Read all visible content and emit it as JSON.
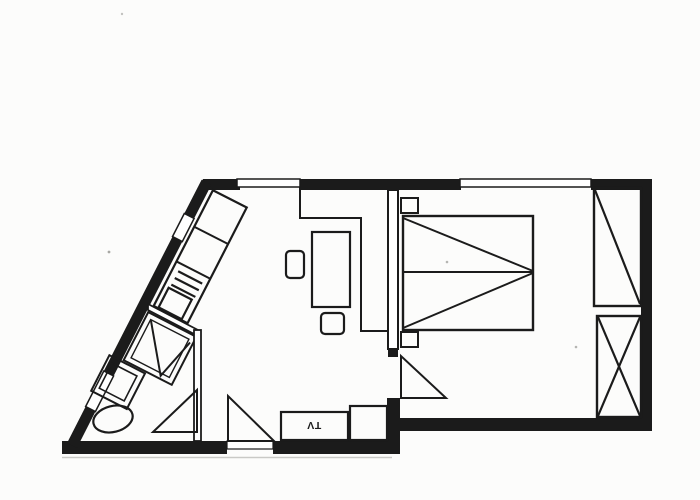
{
  "canvas": {
    "title": "apartment-floor-plan",
    "width": 700,
    "height": 500
  },
  "colors": {
    "ink": "#1b1b1b",
    "paper": "#fcfcfb",
    "white": "#ffffff",
    "shadow": "#c9c9c6",
    "speckle": "#a8a8a4"
  },
  "labels": {
    "tv": "TV"
  },
  "shapes": [
    {
      "t": "polygon",
      "n": "top-wall-corner",
      "a": {
        "points": "203,179 240,179 240,190 198,190",
        "fill": "INK",
        "stroke": "none"
      }
    },
    {
      "t": "rect",
      "n": "top-wall-mid",
      "a": {
        "x": 299,
        "y": 179,
        "width": 162,
        "height": 11,
        "fill": "INK",
        "stroke": "none"
      }
    },
    {
      "t": "rect",
      "n": "top-wall-right",
      "a": {
        "x": 591,
        "y": 179,
        "width": 61,
        "height": 11,
        "fill": "INK",
        "stroke": "none"
      }
    },
    {
      "t": "rect",
      "n": "right-wall",
      "a": {
        "x": 641,
        "y": 179,
        "width": 11,
        "height": 252,
        "fill": "INK",
        "stroke": "none"
      }
    },
    {
      "t": "rect",
      "n": "bedroom-bottom-wall",
      "a": {
        "x": 395,
        "y": 418,
        "width": 257,
        "height": 13,
        "fill": "INK",
        "stroke": "none"
      }
    },
    {
      "t": "rect",
      "n": "hall-bottom-wall-left",
      "a": {
        "x": 62,
        "y": 441,
        "width": 165,
        "height": 13,
        "fill": "INK",
        "stroke": "none"
      }
    },
    {
      "t": "rect",
      "n": "hall-bottom-wall-right",
      "a": {
        "x": 273,
        "y": 441,
        "width": 115,
        "height": 13,
        "fill": "INK",
        "stroke": "none"
      }
    },
    {
      "t": "rect",
      "n": "divider-wall-bottom-bar",
      "a": {
        "x": 387,
        "y": 398,
        "width": 13,
        "height": 56,
        "fill": "INK",
        "stroke": "none"
      }
    },
    {
      "t": "line",
      "n": "diagonal-wall-upper",
      "a": {
        "x1": 206.5,
        "y1": 182.2,
        "x2": 189.2,
        "y2": 216.0,
        "stroke-width": 11
      }
    },
    {
      "t": "line",
      "n": "diagonal-wall-mid",
      "a": {
        "x1": 177.4,
        "y1": 239.1,
        "x2": 108.7,
        "y2": 373.5,
        "stroke-width": 11
      }
    },
    {
      "t": "line",
      "n": "diagonal-wall-lower",
      "a": {
        "x1": 90.5,
        "y1": 409.1,
        "x2": 71.9,
        "y2": 445.6,
        "stroke-width": 11
      }
    },
    {
      "t": "polygon",
      "n": "diagonal-window-small",
      "a": {
        "points": "184.3,213.5 172.5,236.6 182.3,241.6 194.1,218.5",
        "fill": "#ffffff",
        "stroke-width": 1.5
      }
    },
    {
      "t": "polygon",
      "n": "diagonal-window-large",
      "a": {
        "points": "103.8,371 85.6,406.6 95.4,411.6 113.6,376",
        "fill": "#ffffff",
        "stroke-width": 1.5
      }
    },
    {
      "t": "rect",
      "n": "top-window-left",
      "a": {
        "x": 237,
        "y": 179,
        "width": 63,
        "height": 8,
        "fill": "#ffffff",
        "stroke-width": 1.5
      }
    },
    {
      "t": "rect",
      "n": "top-window-right",
      "a": {
        "x": 460,
        "y": 179,
        "width": 131,
        "height": 8,
        "fill": "#ffffff",
        "stroke-width": 1.5
      }
    },
    {
      "t": "rect",
      "n": "entry-door-threshold",
      "a": {
        "x": 227,
        "y": 441,
        "width": 46,
        "height": 8,
        "fill": "#ffffff",
        "stroke-width": 1.2
      }
    },
    {
      "t": "line",
      "n": "scan-shadow-line",
      "a": {
        "x1": 62,
        "y1": 457.5,
        "x2": 392,
        "y2": 457.5,
        "stroke": "#c9c9c6",
        "stroke-width": 1.6
      }
    },
    {
      "t": "g",
      "n": "kitchen-group",
      "a": {
        "transform": "rotate(27.1 212 192)"
      },
      "children": [
        {
          "t": "rect",
          "n": "kitchen-counter",
          "a": {
            "x": 212,
            "y": 190,
            "width": 38,
            "height": 130,
            "stroke-width": 2.2
          }
        },
        {
          "t": "line",
          "n": "counter-divider-1",
          "a": {
            "x1": 212,
            "y1": 231,
            "x2": 250,
            "y2": 231,
            "stroke-width": 2
          }
        },
        {
          "t": "line",
          "n": "counter-divider-2",
          "a": {
            "x1": 212,
            "y1": 270,
            "x2": 250,
            "y2": 270,
            "stroke-width": 2
          }
        },
        {
          "t": "line",
          "n": "drainer-line-1",
          "a": {
            "x1": 218,
            "y1": 278,
            "x2": 245,
            "y2": 278,
            "stroke-width": 2.2
          }
        },
        {
          "t": "line",
          "n": "drainer-line-2",
          "a": {
            "x1": 218,
            "y1": 285.5,
            "x2": 245,
            "y2": 285.5,
            "stroke-width": 2.2
          }
        },
        {
          "t": "line",
          "n": "drainer-line-3",
          "a": {
            "x1": 218,
            "y1": 293,
            "x2": 245,
            "y2": 293,
            "stroke-width": 2.2
          }
        },
        {
          "t": "rect",
          "n": "kitchen-sink",
          "a": {
            "x": 217,
            "y": 297,
            "width": 26,
            "height": 22,
            "stroke-width": 2.2
          }
        },
        {
          "t": "rect",
          "n": "shower-outer",
          "a": {
            "x": 210,
            "y": 328,
            "width": 54,
            "height": 54,
            "stroke-width": 2
          }
        },
        {
          "t": "rect",
          "n": "shower-inner",
          "a": {
            "x": 215.5,
            "y": 333.5,
            "width": 43,
            "height": 43,
            "stroke-width": 1.4
          }
        },
        {
          "t": "polyline",
          "n": "shower-door-fold",
          "a": {
            "points": "216,334 250,379 261,336",
            "stroke-width": 2
          }
        },
        {
          "t": "rect",
          "n": "washbasin-outer",
          "a": {
            "x": 195,
            "y": 384,
            "width": 40,
            "height": 40,
            "stroke-width": 2
          }
        },
        {
          "t": "rect",
          "n": "washbasin-inner",
          "a": {
            "x": 201,
            "y": 390,
            "width": 28,
            "height": 28,
            "stroke-width": 1.6
          }
        }
      ]
    },
    {
      "t": "polygon",
      "n": "bathroom-wall-diagonal",
      "a": {
        "points": "148,304 198,330 198,336 148,310",
        "fill": "#ffffff",
        "stroke-width": 1.8
      }
    },
    {
      "t": "rect",
      "n": "bathroom-wall-vertical",
      "a": {
        "x": 194,
        "y": 330,
        "width": 7,
        "height": 111,
        "fill": "#ffffff",
        "stroke-width": 1.8
      }
    },
    {
      "t": "ellipse",
      "n": "toilet",
      "a": {
        "cx": 113,
        "cy": 419,
        "rx": 20,
        "ry": 13,
        "transform": "rotate(-14 113 419)",
        "stroke-width": 2.2
      }
    },
    {
      "t": "polygon",
      "n": "bathroom-door-leaf",
      "a": {
        "points": "197,390 197,432 153,432",
        "stroke-width": 2
      }
    },
    {
      "t": "polygon",
      "n": "entry-door-leaf",
      "a": {
        "points": "228,396 228,441 274,441",
        "stroke-width": 2
      }
    },
    {
      "t": "polyline",
      "n": "entry-wardrobe-outline",
      "a": {
        "points": "300,190 300,218 361,218 361,331 388,331",
        "stroke-width": 2
      }
    },
    {
      "t": "rect",
      "n": "table",
      "a": {
        "x": 312,
        "y": 232,
        "width": 38,
        "height": 75,
        "stroke-width": 2.2
      }
    },
    {
      "t": "rect",
      "n": "chair-left",
      "a": {
        "x": 286,
        "y": 251,
        "width": 18,
        "height": 27,
        "rx": 4,
        "stroke-width": 2.2
      }
    },
    {
      "t": "rect",
      "n": "chair-bottom",
      "a": {
        "x": 321,
        "y": 313,
        "width": 23,
        "height": 21,
        "rx": 4,
        "stroke-width": 2.2
      }
    },
    {
      "t": "rect",
      "n": "tv-stand",
      "a": {
        "x": 281,
        "y": 412,
        "width": 67,
        "height": 28,
        "stroke-width": 2.2
      }
    },
    {
      "t": "text",
      "n": "tv-label",
      "bind": "labels.tv",
      "a": {
        "x": 314,
        "y": 430,
        "text-anchor": "middle",
        "font-size": "10.5",
        "font-weight": "700",
        "transform": "rotate(180 314 426)",
        "fill": "INK",
        "stroke": "none"
      }
    },
    {
      "t": "rect",
      "n": "tv-side-cabinet",
      "a": {
        "x": 350,
        "y": 406,
        "width": 37,
        "height": 34,
        "stroke-width": 2.2
      }
    },
    {
      "t": "rect",
      "n": "living-bedroom-wall",
      "a": {
        "x": 388,
        "y": 190,
        "width": 10,
        "height": 159,
        "fill": "#ffffff",
        "stroke-width": 2
      }
    },
    {
      "t": "rect",
      "n": "bedroom-door-jamb",
      "a": {
        "x": 388,
        "y": 349,
        "width": 10,
        "height": 8,
        "fill": "INK",
        "stroke": "none"
      }
    },
    {
      "t": "polygon",
      "n": "bedroom-door-leaf",
      "a": {
        "points": "401,356 401,398 446,398",
        "stroke-width": 2
      }
    },
    {
      "t": "rect",
      "n": "double-bed",
      "a": {
        "x": 403,
        "y": 216,
        "width": 130,
        "height": 114,
        "stroke-width": 2.4
      }
    },
    {
      "t": "line",
      "n": "bed-centerline",
      "a": {
        "x1": 403,
        "y1": 272,
        "x2": 533,
        "y2": 272,
        "stroke-width": 2
      }
    },
    {
      "t": "line",
      "n": "bed-diagonal-top",
      "a": {
        "x1": 403,
        "y1": 218,
        "x2": 533,
        "y2": 271,
        "stroke-width": 2
      }
    },
    {
      "t": "line",
      "n": "bed-diagonal-bottom",
      "a": {
        "x1": 403,
        "y1": 328,
        "x2": 533,
        "y2": 273,
        "stroke-width": 2
      }
    },
    {
      "t": "rect",
      "n": "nightstand-top",
      "a": {
        "x": 401,
        "y": 198,
        "width": 17,
        "height": 15,
        "stroke-width": 2
      }
    },
    {
      "t": "rect",
      "n": "nightstand-bottom",
      "a": {
        "x": 401,
        "y": 332,
        "width": 17,
        "height": 15,
        "stroke-width": 2
      }
    },
    {
      "t": "rect",
      "n": "wardrobe-upper",
      "a": {
        "x": 594,
        "y": 188,
        "width": 47,
        "height": 118,
        "stroke-width": 2.4
      }
    },
    {
      "t": "line",
      "n": "wardrobe-upper-diagonal",
      "a": {
        "x1": 595,
        "y1": 190,
        "x2": 640,
        "y2": 304,
        "stroke-width": 2.2
      }
    },
    {
      "t": "rect",
      "n": "wardrobe-lower",
      "a": {
        "x": 597,
        "y": 316,
        "width": 44,
        "height": 101,
        "stroke-width": 2.4
      }
    },
    {
      "t": "line",
      "n": "wardrobe-lower-diagonal-1",
      "a": {
        "x1": 598,
        "y1": 317,
        "x2": 640,
        "y2": 416,
        "stroke-width": 2.2
      }
    },
    {
      "t": "line",
      "n": "wardrobe-lower-diagonal-2",
      "a": {
        "x1": 640,
        "y1": 317,
        "x2": 598,
        "y2": 416,
        "stroke-width": 2.2
      }
    },
    {
      "t": "circle",
      "n": "scan-speckle",
      "a": {
        "cx": 109,
        "cy": 252,
        "r": 1.4,
        "fill": "#a8a8a4",
        "stroke": "none"
      }
    },
    {
      "t": "circle",
      "n": "scan-speckle",
      "a": {
        "cx": 447,
        "cy": 262,
        "r": 1.3,
        "fill": "#b5b5b2",
        "stroke": "none"
      }
    },
    {
      "t": "circle",
      "n": "scan-speckle",
      "a": {
        "cx": 576,
        "cy": 347,
        "r": 1.3,
        "fill": "#b5b5b2",
        "stroke": "none"
      }
    },
    {
      "t": "circle",
      "n": "scan-speckle",
      "a": {
        "cx": 122,
        "cy": 14,
        "r": 1.2,
        "fill": "#c2c2bf",
        "stroke": "none"
      }
    }
  ]
}
